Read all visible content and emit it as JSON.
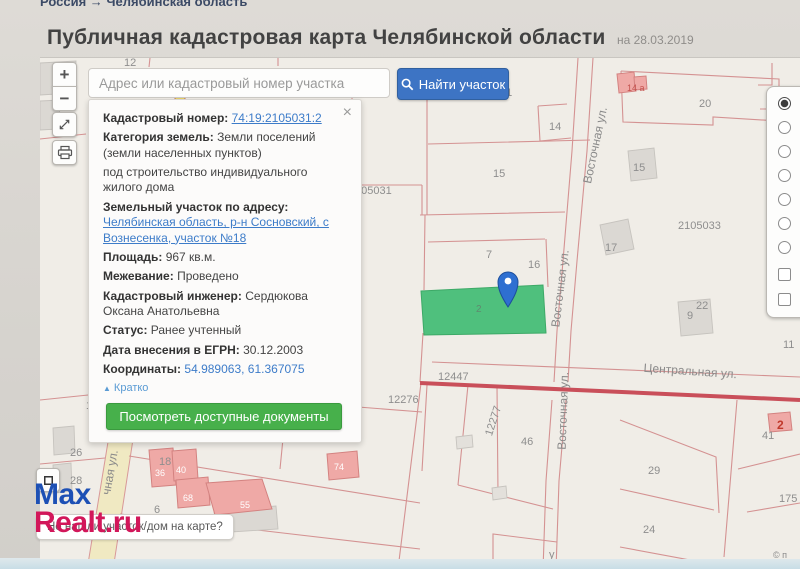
{
  "page": {
    "breadcrumb": "Россия → Челябинская область",
    "title": "Публичная кадастровая карта Челябинской области",
    "date_note": "на 28.03.2019"
  },
  "search": {
    "placeholder": "Адрес или кадастровый номер участка",
    "button_label": "Найти участок"
  },
  "controls": {
    "zoom_in": "+",
    "zoom_out": "−"
  },
  "popup": {
    "close_icon": "×",
    "cadastral_number_label": "Кадастровый номер:",
    "cadastral_number": "74:19:2105031:2",
    "category_label": "Категория земель:",
    "category_value": "Земли поселений (земли населенных пунктов)",
    "permitted_use": "под строительство индивидуального жилого дома",
    "address_label": "Земельный участок по адресу:",
    "address_value": "Челябинская область, р-н Сосновский, с Вознесенка, участок №18",
    "area_label": "Площадь:",
    "area_value": "967 кв.м.",
    "survey_label": "Межевание:",
    "survey_value": "Проведено",
    "engineer_label": "Кадастровый инженер:",
    "engineer_value": "Сердюкова Оксана Анатольевна",
    "status_label": "Статус:",
    "status_value": "Ранее учтенный",
    "egrn_label": "Дата внесения в ЕГРН:",
    "egrn_value": "30.12.2003",
    "coords_label": "Координаты:",
    "coords_value": "54.989063, 61.367075",
    "collapse_icon": "▲",
    "collapse_label": "Кратко",
    "documents_button": "Посмотреть доступные документы"
  },
  "map": {
    "streets": {
      "vostochnaya_1": "Восточная ул.",
      "vostochnaya_2": "Восточная ул.",
      "vostochnaya_3": "Восточная ул.",
      "centralnaya": "Центральная ул.",
      "solnechnaya_partial": "чная ул."
    },
    "labels": {
      "p12": "12",
      "p31": "31",
      "p14_road": "14",
      "p20": "20",
      "p15_west": "15",
      "p15_east": "15",
      "quarter_2105033": "2105033",
      "p17_east": "17",
      "quarter_105031": "105031",
      "p7": "7",
      "p16": "16",
      "p2_green": "2",
      "p14a": "14 а",
      "p9": "9",
      "p9_sup": "22",
      "p11": "11",
      "p12447": "12447",
      "p12276": "12276",
      "p12277": "12277",
      "p46": "46",
      "p29": "29",
      "p24": "24",
      "p175": "175",
      "p41": "41",
      "p2_red": "2",
      "p19": "19",
      "route74": "74",
      "p17_west": "17",
      "p18": "18",
      "p26": "26",
      "p28": "28",
      "p6": "6",
      "b33": "33",
      "b36": "36",
      "b40": "40",
      "b68": "68",
      "b55": "55",
      "b74": "74",
      "py": "у",
      "copyright": "© п"
    }
  },
  "footer": {
    "tooltip": "Не нашли участок/дом на карте?"
  },
  "watermark": {
    "line1": "Max",
    "line2": "Realt.ru"
  },
  "colors": {
    "selected_parcel_green": "#4fc07d",
    "marker_blue": "#2e6fd1",
    "road_red": "#c94f5a",
    "link_blue": "#3d7cc9",
    "find_button_blue": "#3d74c4",
    "documents_button_green": "#47b04b",
    "logo_blue": "#1d50b5",
    "logo_red": "#d2175a"
  }
}
